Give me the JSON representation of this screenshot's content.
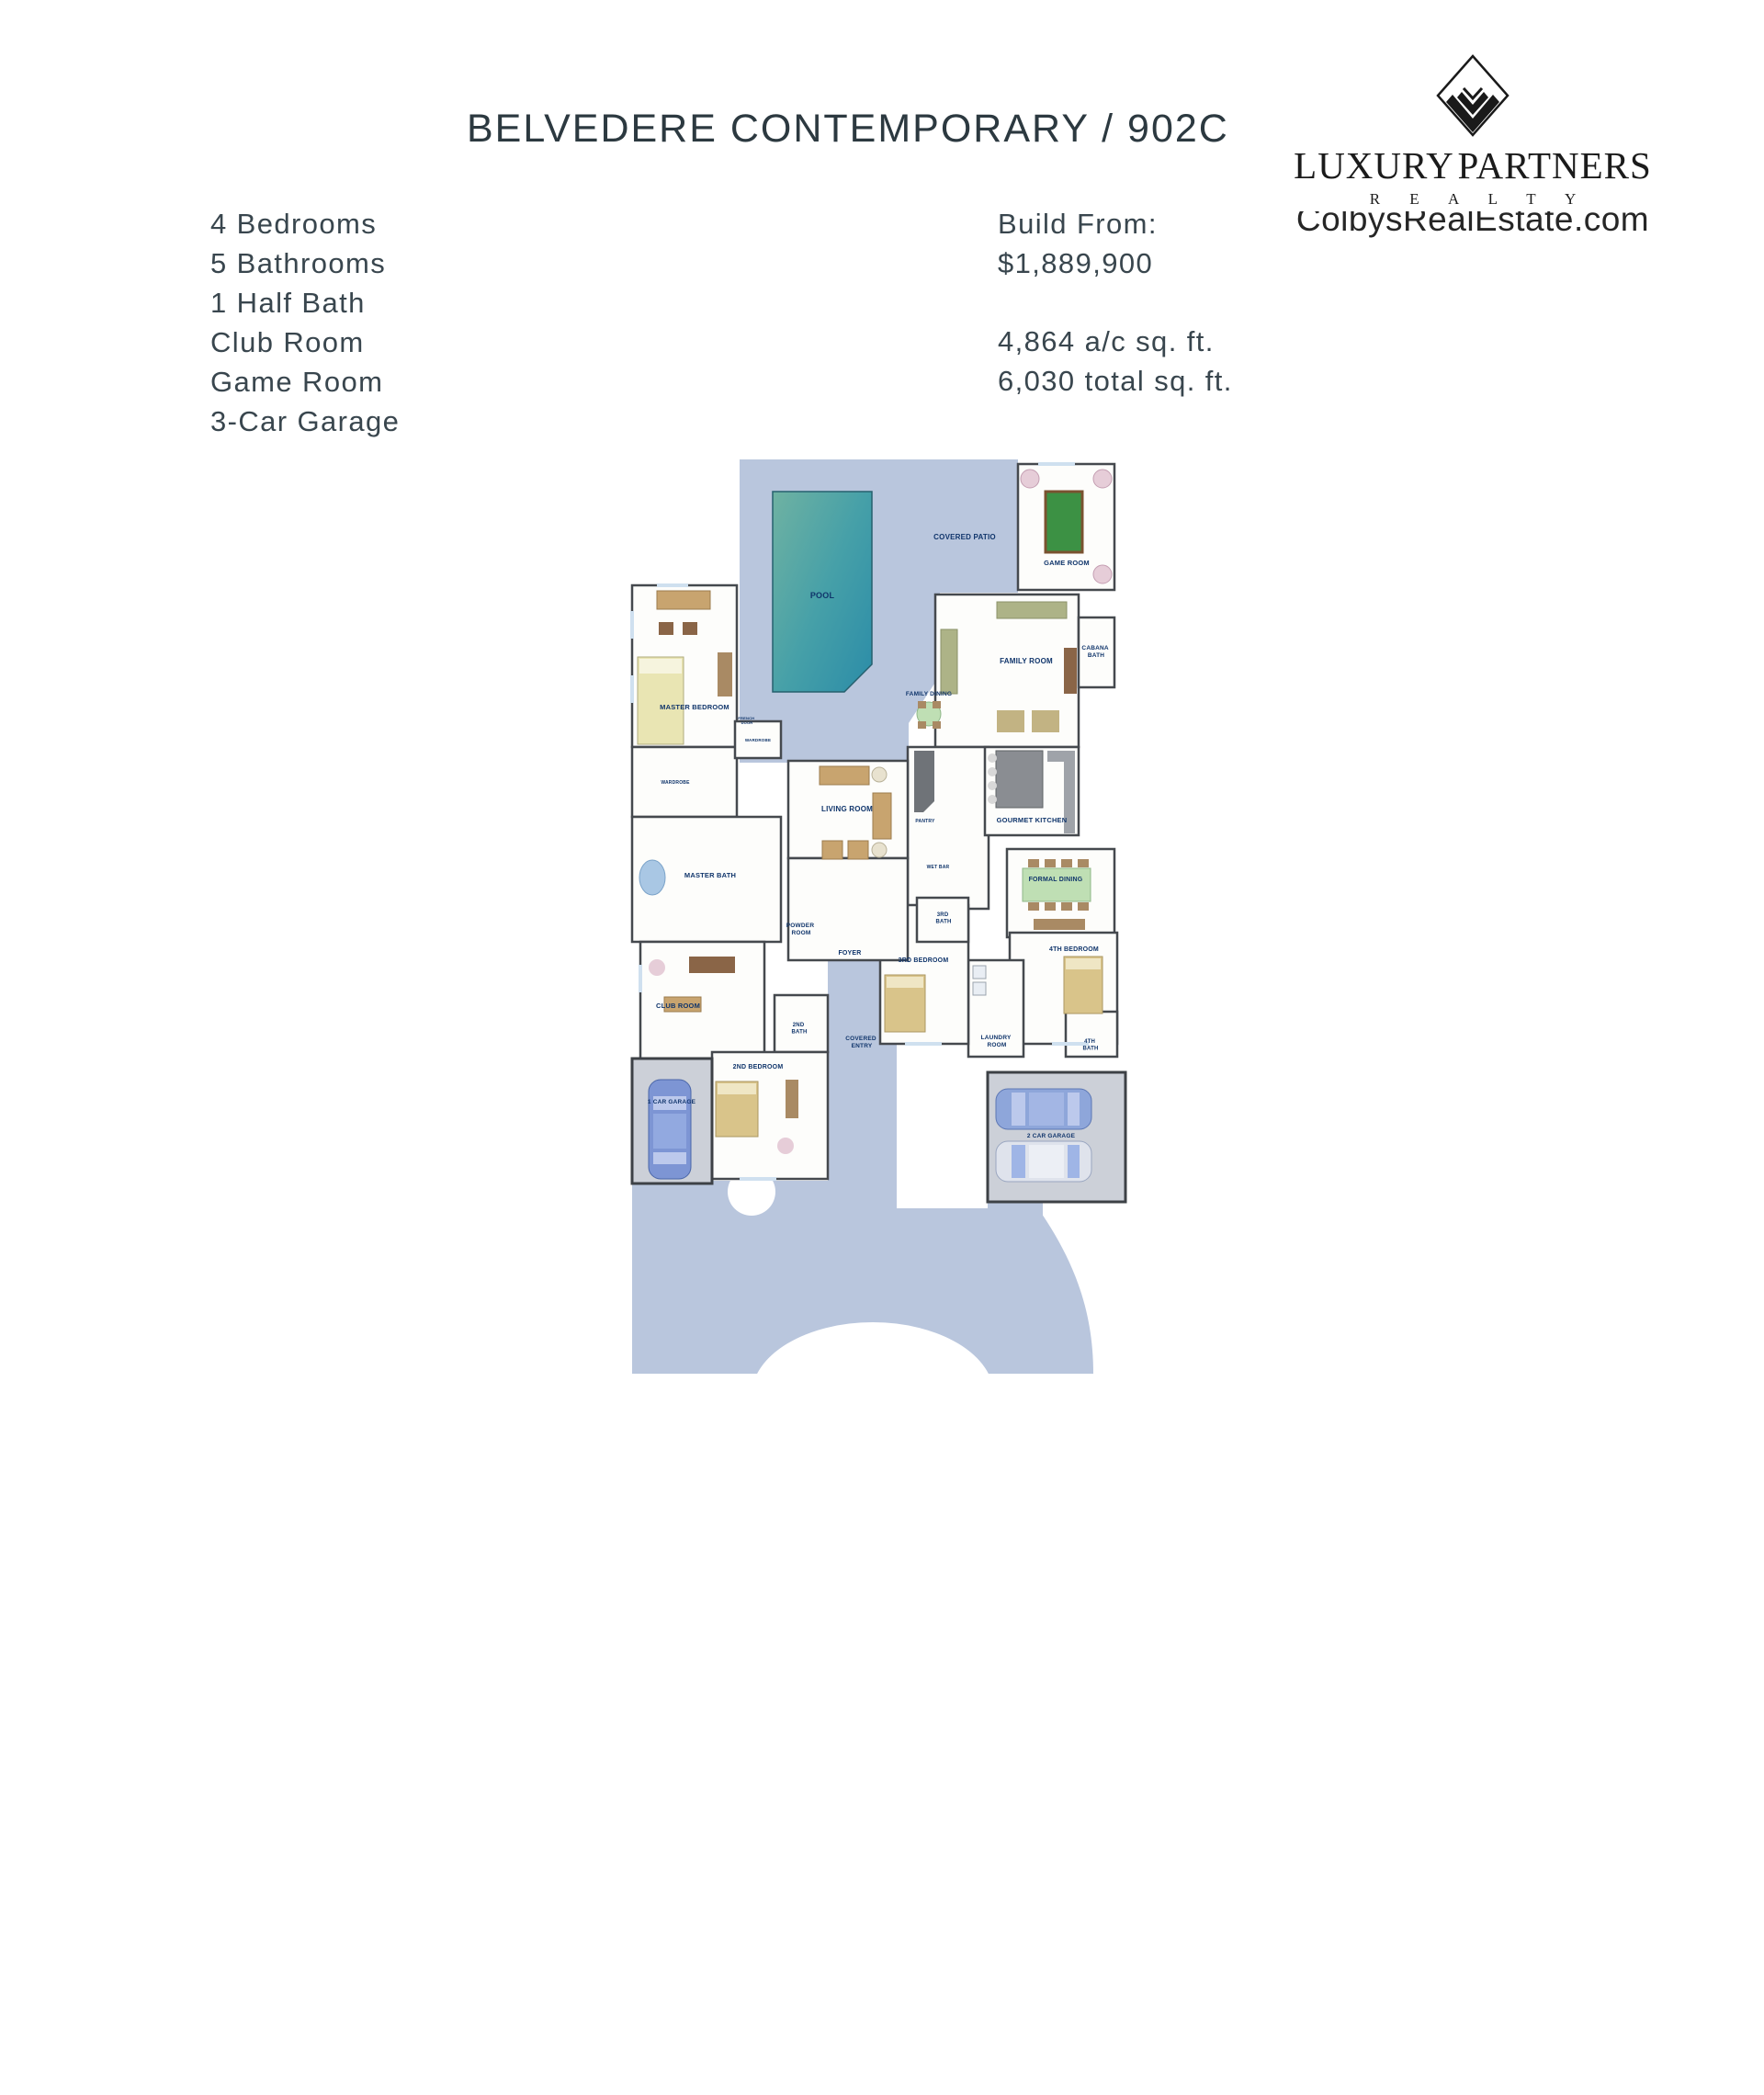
{
  "header": {
    "title": "BELVEDERE CONTEMPORARY / 902C",
    "logo": {
      "name": "LUXURY PARTNERS",
      "realty": "R E A L T Y",
      "watermark": "ColbysRealEstate.com"
    }
  },
  "features": [
    "4 Bedrooms",
    "5 Bathrooms",
    "1 Half Bath",
    "Club Room",
    "Game Room",
    "3-Car Garage"
  ],
  "pricing": {
    "build_from_label": "Build From:",
    "price": "$1,889,900",
    "ac_sqft": "4,864 a/c sq. ft.",
    "total_sqft": "6,030 total sq. ft."
  },
  "floorplan": {
    "labels": {
      "pool": "POOL",
      "covered_patio": "COVERED PATIO",
      "game_room": "GAME ROOM",
      "cabana_bath": [
        "CABANA",
        "BATH"
      ],
      "family_room": "FAMILY ROOM",
      "family_dining": "FAMILY DINING",
      "master_bedroom": "MASTER BEDROOM",
      "wardrobe1": "WARDROBE",
      "wardrobe2": "WARDROBE",
      "french_door": [
        "FRENCH",
        "DOOR"
      ],
      "living_room": "LIVING ROOM",
      "gourmet_kitchen": "GOURMET KITCHEN",
      "pantry": "PANTRY",
      "wet_bar": "WET BAR",
      "master_bath": "MASTER BATH",
      "formal_dining": "FORMAL DINING",
      "powder_room": [
        "POWDER",
        "ROOM"
      ],
      "foyer": "FOYER",
      "third_bath": [
        "3RD",
        "BATH"
      ],
      "third_bedroom": "3RD BEDROOM",
      "fourth_bedroom": "4TH BEDROOM",
      "club_room": "CLUB ROOM",
      "second_bath": [
        "2ND",
        "BATH"
      ],
      "covered_entry": [
        "COVERED",
        "ENTRY"
      ],
      "laundry_room": [
        "LAUNDRY",
        "ROOM"
      ],
      "fourth_bath": [
        "4TH",
        "BATH"
      ],
      "second_bedroom": "2ND BEDROOM",
      "one_car_garage": "1 CAR GARAGE",
      "two_car_garage": "2 CAR GARAGE"
    }
  },
  "colors": {
    "title_text": "#2c3940",
    "body_text": "#39464e",
    "logo_ink": "#1a1a1a",
    "patio": "#b9c6dd",
    "pool_light": "#6fb2a2",
    "pool_dark": "#2f8fa8",
    "garage_floor": "#ccd0d8",
    "wall": "#45494e",
    "room_label": "#10356b",
    "pool_table_green": "#3c9144",
    "dining_table_green": "#bfdfb4"
  }
}
